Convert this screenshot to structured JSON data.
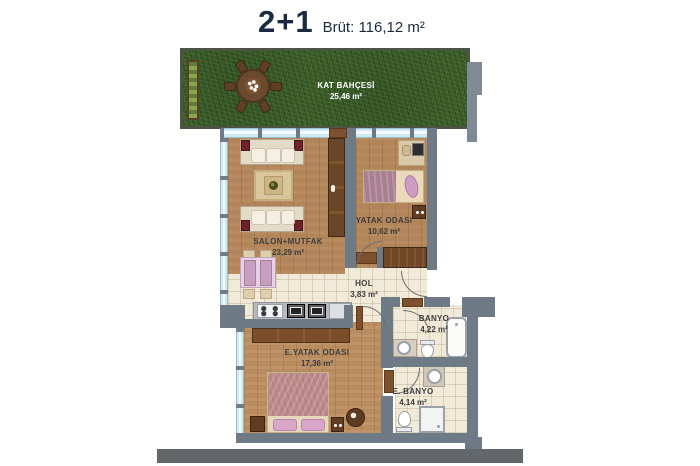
{
  "header": {
    "unit_type": "2+1",
    "gross": "Brüt: 116,12 m²"
  },
  "garden": {
    "name": "KAT BAHÇESİ",
    "area": "25,46 m²"
  },
  "rooms": {
    "salon": {
      "name": "SALON+MUTFAK",
      "area": "23,29 m²"
    },
    "bedroom": {
      "name": "YATAK ODASI",
      "area": "10,62 m²"
    },
    "hall": {
      "name": "HOL",
      "area": "3,83 m²"
    },
    "bathroom": {
      "name": "BANYO",
      "area": "4,22 m²"
    },
    "master_bedroom": {
      "name": "E.YATAK ODASI",
      "area": "17,36 m²"
    },
    "ensuite_bathroom": {
      "name": "E. BANYO",
      "area": "4,14 m²"
    }
  },
  "colors": {
    "wall": "#6e7a85",
    "glass": "#cfe9f3",
    "wood": "#b3855a",
    "tile": "#f1ead9",
    "grass": "#41632e",
    "title_text": "#1a2b3f"
  }
}
